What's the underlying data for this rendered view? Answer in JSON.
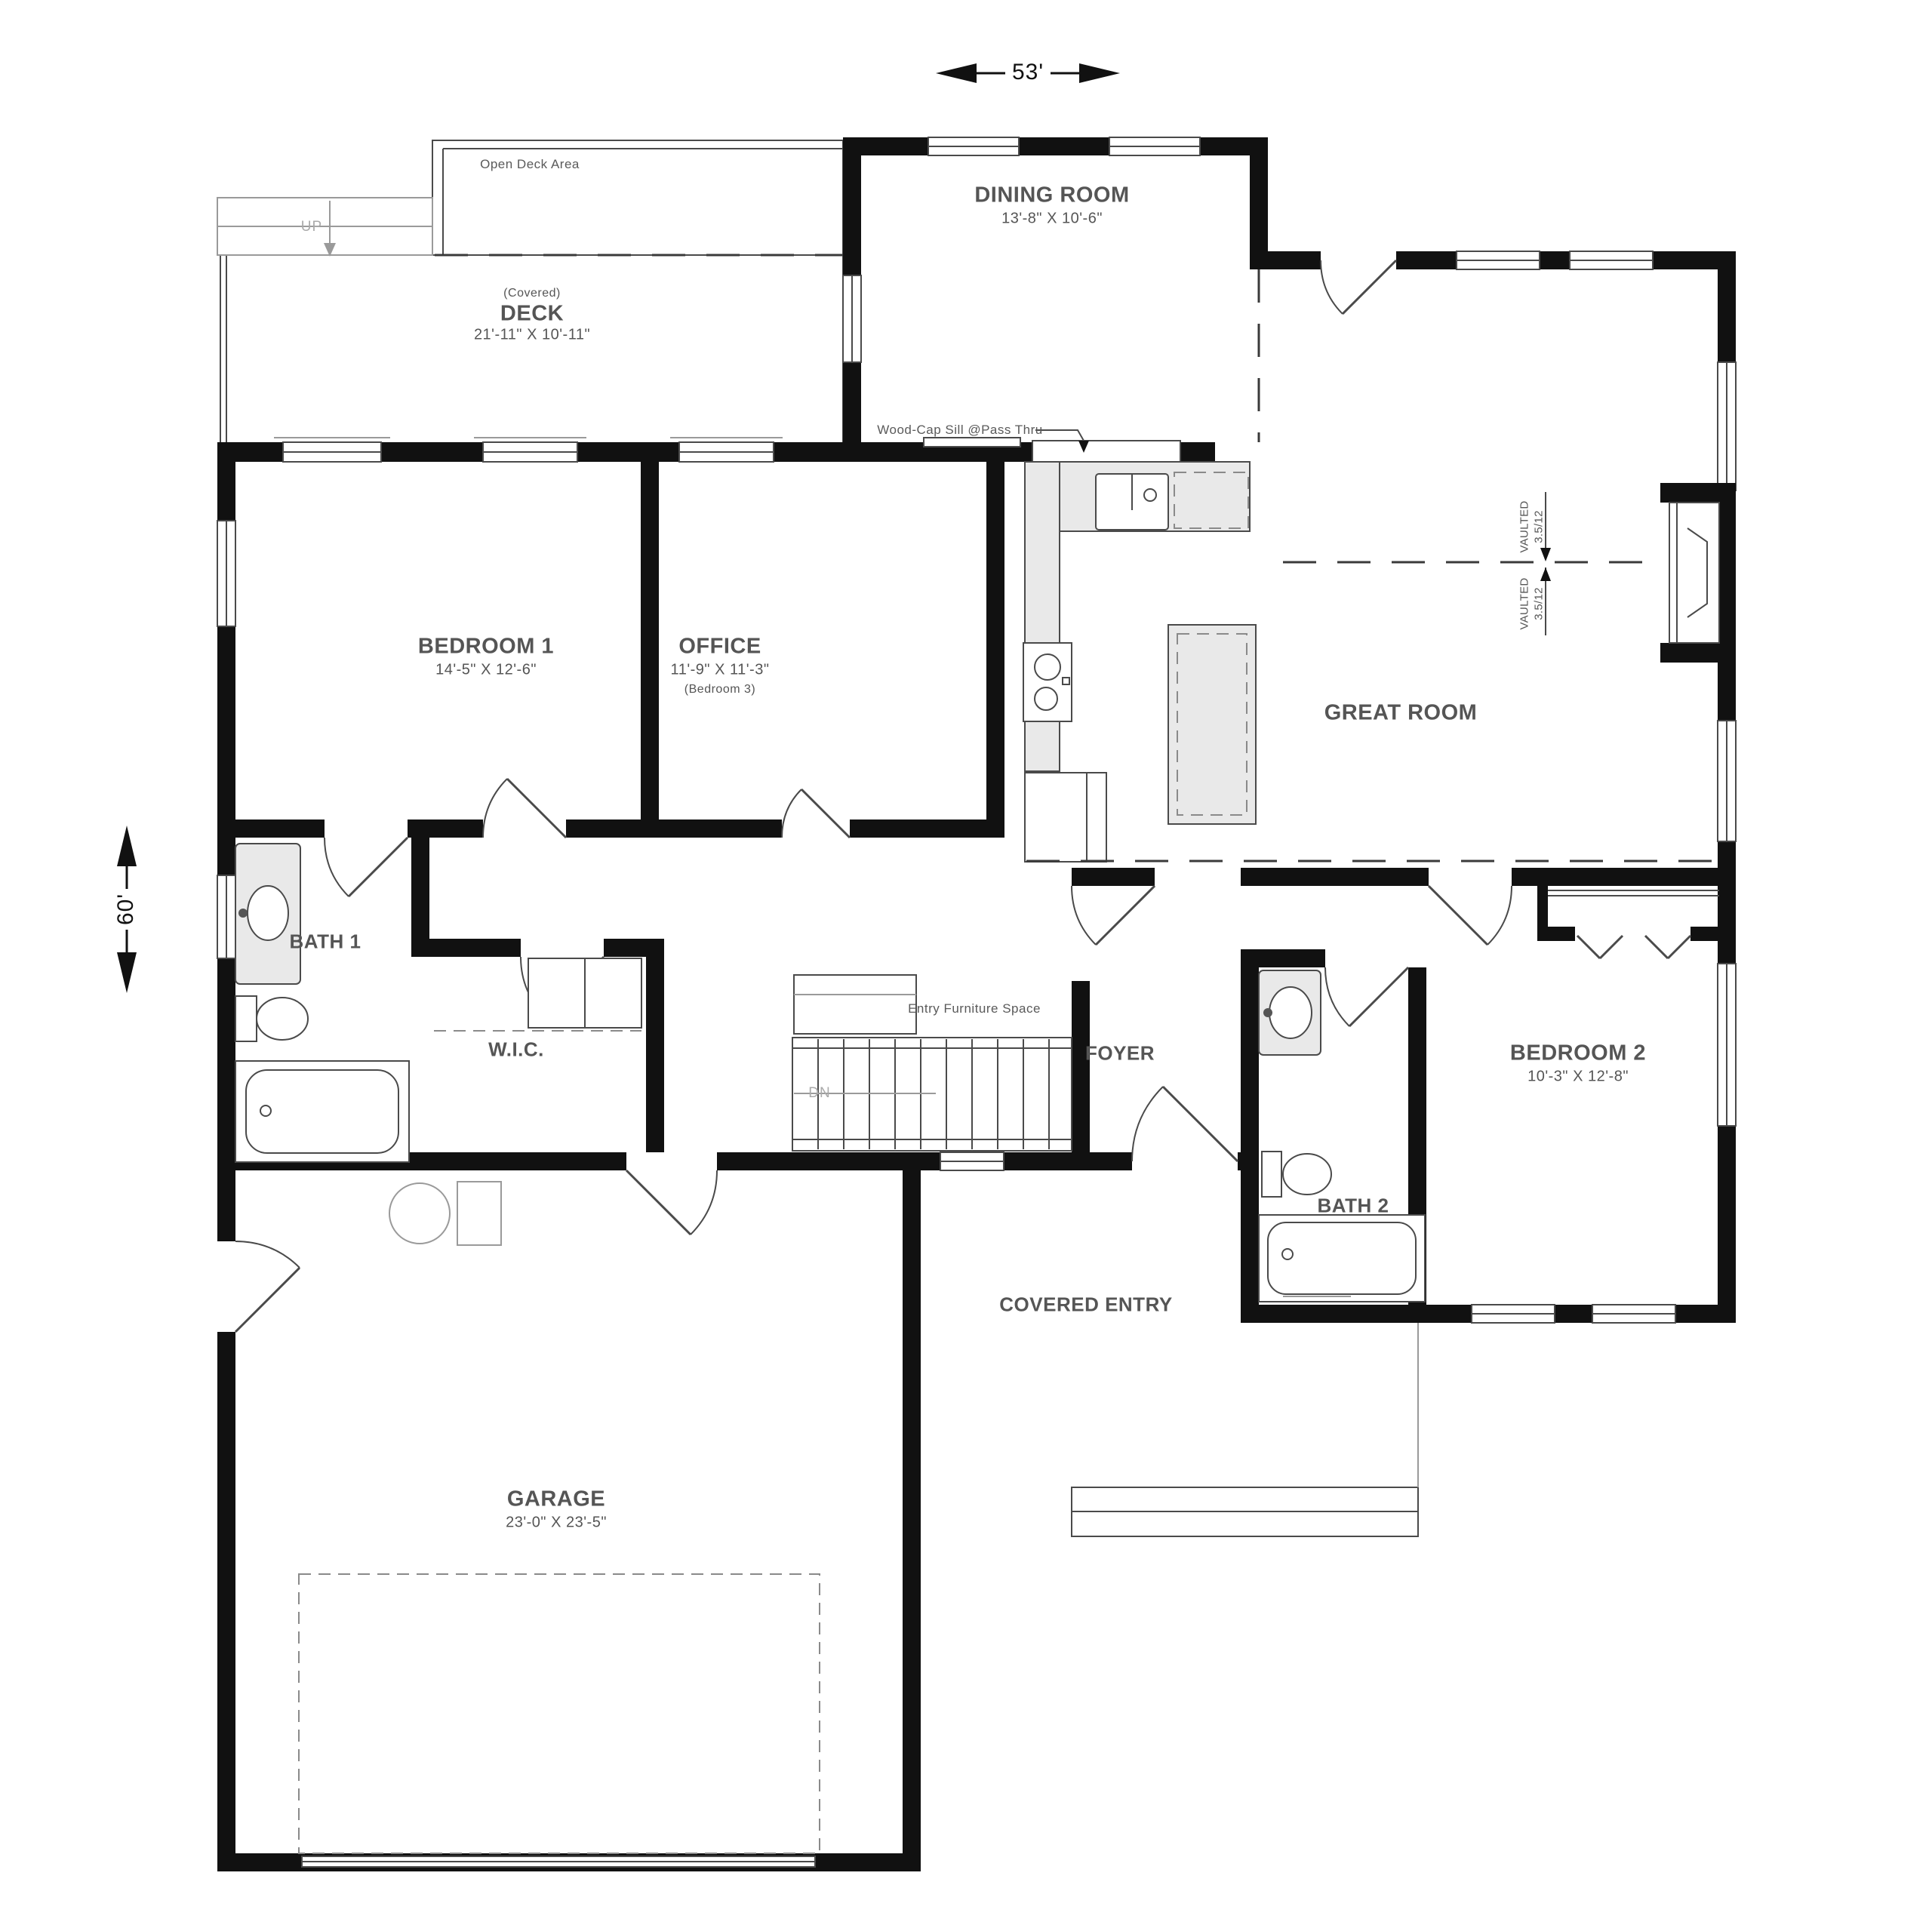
{
  "dimensions": {
    "width_label": "53'",
    "height_label": "60'"
  },
  "rooms": {
    "open_deck": {
      "label": "Open Deck Area"
    },
    "deck": {
      "qualifier": "(Covered)",
      "label": "DECK",
      "size": "21'-11\" X 10'-11\""
    },
    "dining_room": {
      "label": "DINING ROOM",
      "size": "13'-8\" X 10'-6\""
    },
    "bedroom1": {
      "label": "BEDROOM 1",
      "size": "14'-5\" X 12'-6\""
    },
    "office": {
      "label": "OFFICE",
      "size": "11'-9\" X 11'-3\"",
      "alt_label": "(Bedroom 3)"
    },
    "great_room": {
      "label": "GREAT ROOM"
    },
    "bath1": {
      "label": "BATH 1"
    },
    "wic": {
      "label": "W.I.C."
    },
    "foyer": {
      "label": "FOYER"
    },
    "bedroom2": {
      "label": "BEDROOM 2",
      "size": "10'-3\" X 12'-8\""
    },
    "bath2": {
      "label": "BATH 2"
    },
    "covered_entry": {
      "label": "COVERED ENTRY"
    },
    "garage": {
      "label": "GARAGE",
      "size": "23'-0\" X 23'-5\""
    }
  },
  "annotations": {
    "wood_cap_sill": "Wood-Cap Sill @Pass Thru",
    "entry_furniture": "Entry Furniture Space",
    "stairs_up": "UP",
    "stairs_down": "DN",
    "vaulted": "VAULTED",
    "vault_pitch": "3.5/12"
  },
  "colors": {
    "wall": "#111111",
    "line": "#4a4a4a",
    "light_line": "#9a9a9a",
    "fixture_fill": "#e9e9e9",
    "label_text": "#555555"
  }
}
